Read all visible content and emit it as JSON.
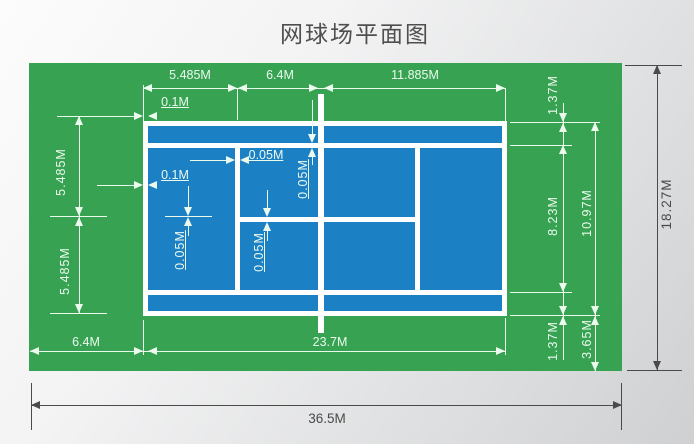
{
  "title": "网球场平面图",
  "colors": {
    "surround_green": "#36a252",
    "court_blue": "#1c80c5",
    "court_line_white": "#ffffff",
    "dim_light": "#ecfaee",
    "dim_dark": "#4a4a4a"
  },
  "top_dims": [
    "5.485M",
    "6.4M",
    "11.885M"
  ],
  "left_dims": [
    "5.485M",
    "5.485M"
  ],
  "right_dims": {
    "alley_top": "1.37M",
    "singles_width": "8.23M",
    "alley_bottom": "1.37M",
    "doubles_width": "10.97M",
    "side_margin": "3.65M",
    "total_height": "18.27M"
  },
  "bottom_dims": {
    "end_margin": "6.4M",
    "court_length": "23.7M",
    "total_length": "36.5M"
  },
  "line_width_notes": {
    "baseline_width_top": "0.1M",
    "sideline_width": "0.1M",
    "service_line_width": "0.05M",
    "singles_sideline_width": "0.05M",
    "centre_mark_width": "0.05M",
    "centre_service_line_width": "0.05M"
  }
}
